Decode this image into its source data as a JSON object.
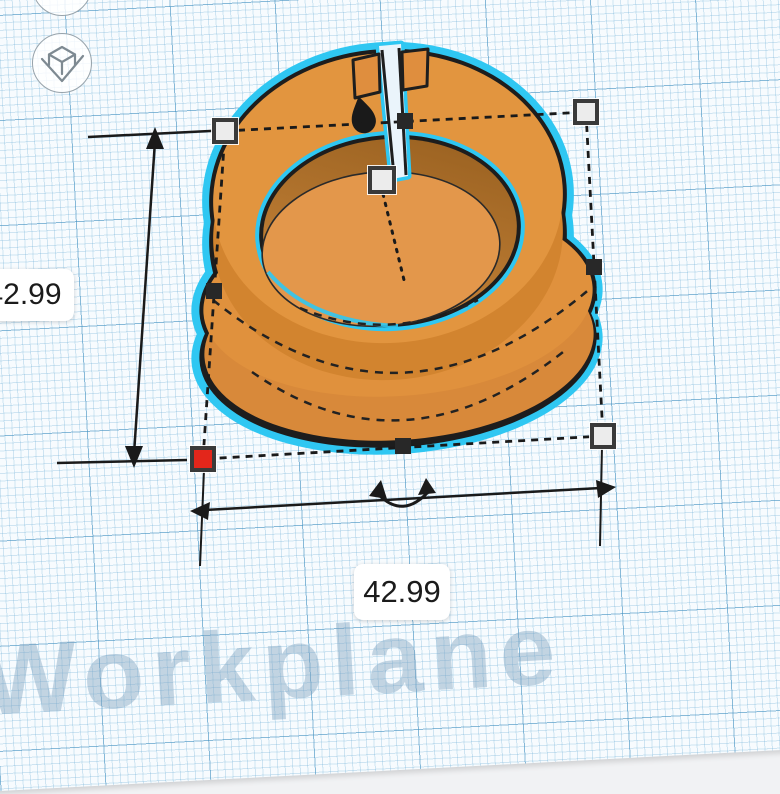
{
  "viewport": {
    "watermark": "Workplane"
  },
  "selection": {
    "height_label": "42.99",
    "width_label": "42.99"
  },
  "controls": {
    "top_button_icon": "view-cube-icon",
    "home_button_icon": "home-view-icon"
  },
  "colors": {
    "model_orange_top": "#E2953F",
    "model_orange_side": "#D8893A",
    "highlight_cyan": "#2FC7F2",
    "active_handle_red": "#E3261B",
    "handle_fill": "#ECECEC",
    "handle_border": "#3A3A3A",
    "grid_blue_major": "#408EBE",
    "grid_blue_minor": "#6EAFD7",
    "paper": "#F7FBFE",
    "off_plane_background": "#F1F2F4"
  }
}
